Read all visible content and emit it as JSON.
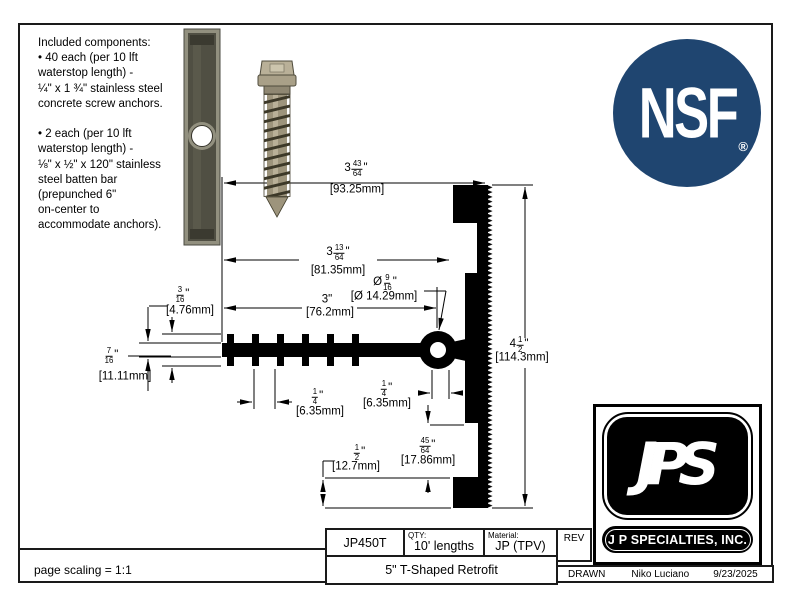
{
  "drawing": {
    "notes": {
      "lines": [
        "Included components:",
        "• 40 each (per 10 lft",
        "waterstop length) -",
        "¼\" x 1 ¾\" stainless steel",
        "concrete screw anchors.",
        "",
        "• 2 each (per 10 lft",
        "waterstop length) -",
        "⅛\" x ½\" x 120\" stainless",
        "steel batten bar",
        "(prepunched 6\"",
        "on-center to",
        "accommodate anchors)."
      ]
    },
    "dims": {
      "top": {
        "w": "3",
        "n": "43",
        "d": "64",
        "q": "\"",
        "mm": "[93.25mm]"
      },
      "mid": {
        "w": "3",
        "n": "13",
        "d": "64",
        "q": "\"",
        "mm": "[81.35mm]"
      },
      "dia": {
        "w": "Ø ",
        "n": "9",
        "d": "16",
        "q": "\"",
        "mm": "[Ø 14.29mm]"
      },
      "three": {
        "w": "3\"",
        "n": "",
        "d": "",
        "q": "",
        "mm": "[76.2mm]"
      },
      "t316": {
        "w": "",
        "n": "3",
        "d": "16",
        "q": "\"",
        "mm": "[4.76mm]"
      },
      "t716": {
        "w": "",
        "n": "7",
        "d": "16",
        "q": "\"",
        "mm": "[11.11mm]"
      },
      "rib": {
        "w": "",
        "n": "1",
        "d": "4",
        "q": "\"",
        "mm": "[6.35mm]"
      },
      "neck": {
        "w": "",
        "n": "1",
        "d": "4",
        "q": "\"",
        "mm": "[6.35mm]"
      },
      "q4564": {
        "w": "",
        "n": "45",
        "d": "64",
        "q": "\"",
        "mm": "[17.86mm]"
      },
      "half": {
        "w": "",
        "n": "1",
        "d": "2",
        "q": "\"",
        "mm": "[12.7mm]"
      },
      "height": {
        "w": "4",
        "n": "1",
        "d": "2",
        "q": "\"",
        "mm": "[114.3mm]"
      }
    },
    "scaling_note": "page scaling = 1:1"
  },
  "logos": {
    "nsf": {
      "text": "NSF",
      "reg": "®",
      "circle_color": "#1f4570"
    },
    "jps": {
      "script": "JPS",
      "company": "J P SPECIALTIES, INC."
    }
  },
  "title_block": {
    "part_number": "JP450T",
    "qty_label": "QTY:",
    "qty_value": "10' lengths",
    "material_label": "Material:",
    "material_value": "JP (TPV)",
    "rev_label": "REV",
    "product_title": "5\" T-Shaped Retrofit",
    "drawn_label": "DRAWN",
    "drawn_by": "Niko Luciano",
    "drawn_date": "9/23/2025"
  }
}
